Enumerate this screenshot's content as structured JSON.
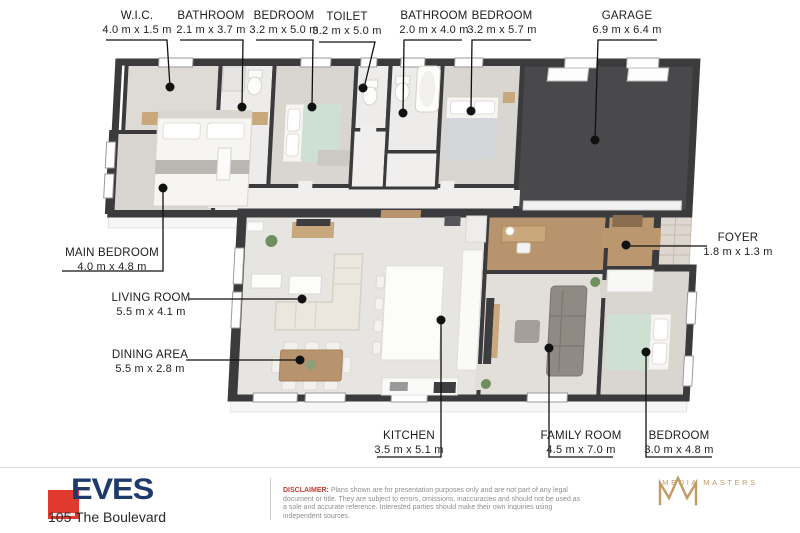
{
  "floor_plan": {
    "room_labels": [
      {
        "name": "W.I.C.",
        "dims": "4.0 m x 1.5 m"
      },
      {
        "name": "BATHROOM",
        "dims": "2.1 m x 3.7 m"
      },
      {
        "name": "BEDROOM",
        "dims": "3.2 m x 5.0 m"
      },
      {
        "name": "TOILET",
        "dims": "3.2 m x 5.0 m"
      },
      {
        "name": "BATHROOM",
        "dims": "2.0 m x 4.0 m"
      },
      {
        "name": "BEDROOM",
        "dims": "3.2 m x 5.7 m"
      },
      {
        "name": "GARAGE",
        "dims": "6.9 m x 6.4 m"
      },
      {
        "name": "MAIN BEDROOM",
        "dims": "4.0 m x 4.8 m"
      },
      {
        "name": "LIVING ROOM",
        "dims": "5.5 m x 4.1 m"
      },
      {
        "name": "DINING AREA",
        "dims": "5.5 m x 2.8 m"
      },
      {
        "name": "FOYER",
        "dims": "1.8 m x 1.3 m"
      },
      {
        "name": "KITCHEN",
        "dims": "3.5 m x 5.1 m"
      },
      {
        "name": "FAMILY ROOM",
        "dims": "4.5 m x 7.0 m"
      },
      {
        "name": "BEDROOM",
        "dims": "3.0 m x 4.8 m"
      }
    ]
  },
  "footer": {
    "agency_name": "EVES",
    "address": "105 The Boulevard",
    "disclaimer_label": "DISCLAIMER:",
    "disclaimer_text": " Plans shown are for presentation purposes only and are not part of any legal document or title. They are subject to errors, omissions, inaccuracies and should not be used as a sole and accurate reference. Interested parties should make their own inquiries using independent sources.",
    "media_credit": "MEDIA MASTERS"
  },
  "colors": {
    "wall": "#3b3b3d",
    "garage_floor": "#49494b",
    "wood_floor": "#b8946e",
    "carpet": "#d8d5d1",
    "brand_red": "#e03a2f",
    "brand_navy": "#1e3a6d",
    "gold": "#c29a66"
  }
}
